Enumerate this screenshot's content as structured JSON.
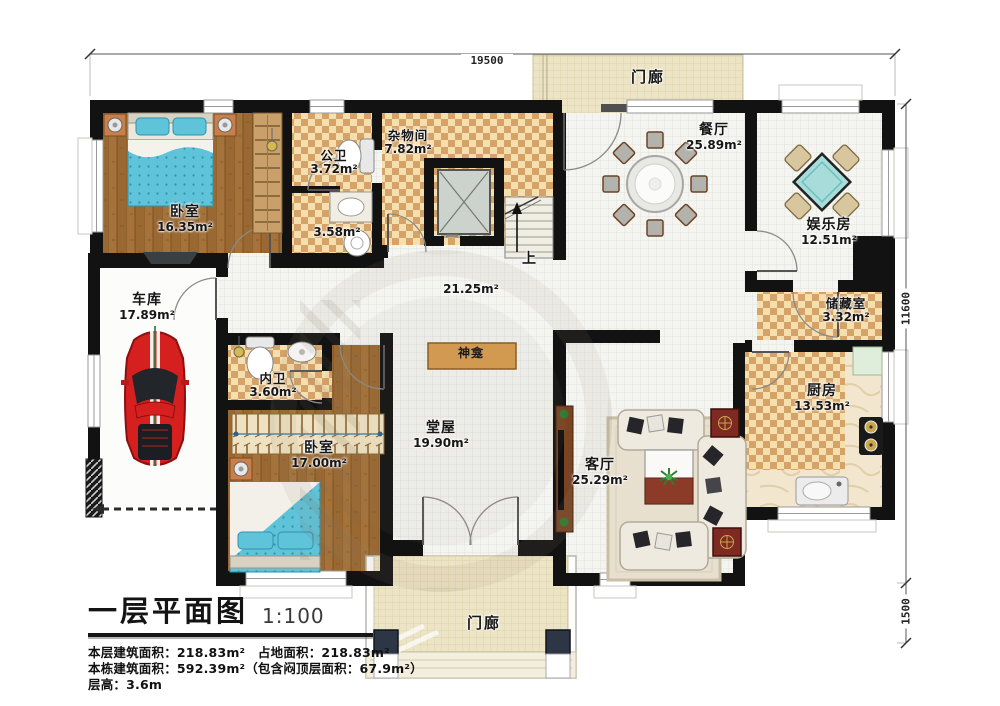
{
  "title": {
    "main": "一层平面图",
    "scale": "1:100"
  },
  "info_lines": [
    "本层建筑面积：218.83m²　占地面积：218.83m²",
    "本栋建筑面积：592.39m²（包含闷顶层面积：67.9m²）",
    "层高：3.6m"
  ],
  "dimensions": {
    "top": "19500",
    "right_upper": "11600",
    "right_lower": "1500"
  },
  "rooms": [
    {
      "id": "bedroom1",
      "name": "卧室",
      "area": "16.35m²"
    },
    {
      "id": "public_bath",
      "name": "公卫",
      "area": "3.72m²"
    },
    {
      "id": "bath_lower",
      "name": "",
      "area": "3.58m²"
    },
    {
      "id": "utility",
      "name": "杂物间",
      "area": "7.82m²"
    },
    {
      "id": "dining",
      "name": "餐厅",
      "area": "25.89m²"
    },
    {
      "id": "entertainment",
      "name": "娱乐房",
      "area": "12.51m²"
    },
    {
      "id": "storage",
      "name": "储藏室",
      "area": "3.32m²"
    },
    {
      "id": "kitchen",
      "name": "厨房",
      "area": "13.53m²"
    },
    {
      "id": "garage",
      "name": "车库",
      "area": "17.89m²"
    },
    {
      "id": "inner_bath",
      "name": "内卫",
      "area": "3.60m²"
    },
    {
      "id": "bedroom2",
      "name": "卧室",
      "area": "17.00m²"
    },
    {
      "id": "hall",
      "name": "堂屋",
      "area": "19.90m²"
    },
    {
      "id": "living",
      "name": "客厅",
      "area": "25.29m²"
    },
    {
      "id": "corridor",
      "name": "",
      "area": "21.25m²"
    },
    {
      "id": "porch_top",
      "name": "门廊",
      "area": ""
    },
    {
      "id": "porch_bottom",
      "name": "门廊",
      "area": ""
    }
  ],
  "annotations": {
    "shrine": "神龛",
    "stairs_up": "上"
  },
  "colors": {
    "wall": "#121212",
    "checker_light": "#f6dfae",
    "checker_dark": "#d5a268",
    "wood": "#9a6832",
    "water_blue": "#5fc3da",
    "car_red": "#d61f1f",
    "shrine_orange": "#d89a4e",
    "pillar_navy": "#2c3644"
  }
}
